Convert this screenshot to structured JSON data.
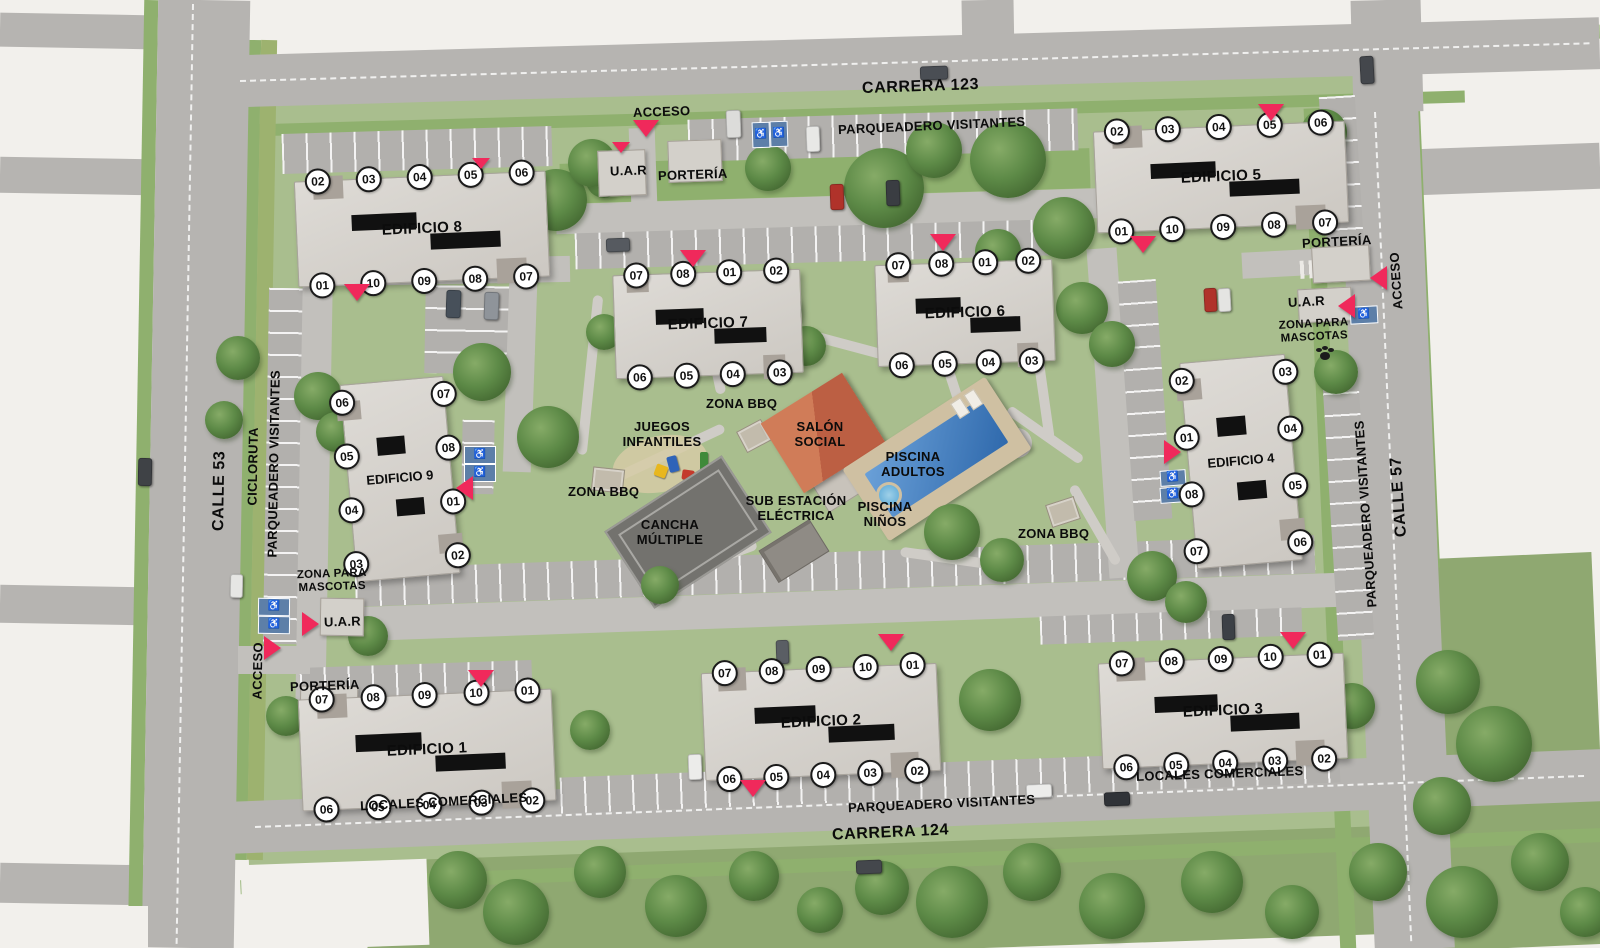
{
  "streets": {
    "carrera_123": "CARRERA 123",
    "carrera_124": "CARRERA 124",
    "calle_53": "CALLE 53",
    "calle_57": "CALLE 57",
    "cicloruta": "CICLORUTA"
  },
  "labels": {
    "parqueadero_visitantes": "PARQUEADERO VISITANTES",
    "acceso": "ACCESO",
    "porteria": "PORTERÍA",
    "uar": "U.A.R",
    "zona_para_mascotas": "ZONA PARA MASCOTAS",
    "zona_bbq": "ZONA BBQ",
    "locales_comerciales": "LOCALES COMERCIALES"
  },
  "amenities": {
    "salon_social": "SALÓN SOCIAL",
    "piscina_adultos": "PISCINA ADULTOS",
    "piscina_ninos": "PISCINA NIÑOS",
    "juegos_infantiles": "JUEGOS INFANTILES",
    "sub_estacion_electrica": "SUB ESTACIÓN ELÉCTRICA",
    "cancha_multiple": "CANCHA MÚLTIPLE"
  },
  "buildings": [
    {
      "id": "edificio-8",
      "name": "EDIFICIO 8",
      "units_top": [
        "02",
        "03",
        "04",
        "05",
        "06"
      ],
      "units_bottom": [
        "01",
        "10",
        "09",
        "08",
        "07"
      ]
    },
    {
      "id": "edificio-5",
      "name": "EDIFICIO 5",
      "units_top": [
        "02",
        "03",
        "04",
        "05",
        "06"
      ],
      "units_bottom": [
        "01",
        "10",
        "09",
        "08",
        "07"
      ]
    },
    {
      "id": "edificio-7",
      "name": "EDIFICIO 7",
      "units_top": [
        "07",
        "08",
        "01",
        "02"
      ],
      "units_bottom": [
        "06",
        "05",
        "04",
        "03"
      ]
    },
    {
      "id": "edificio-6",
      "name": "EDIFICIO 6",
      "units_top": [
        "07",
        "08",
        "01",
        "02"
      ],
      "units_bottom": [
        "06",
        "05",
        "04",
        "03"
      ]
    },
    {
      "id": "edificio-9",
      "name": "EDIFICIO 9",
      "units_left": [
        "06",
        "05",
        "04",
        "03"
      ],
      "units_right": [
        "07",
        "08",
        "01",
        "02"
      ]
    },
    {
      "id": "edificio-4",
      "name": "EDIFICIO 4",
      "units_left": [
        "02",
        "01",
        "08",
        "07"
      ],
      "units_right": [
        "03",
        "04",
        "05",
        "06"
      ]
    },
    {
      "id": "edificio-1",
      "name": "EDIFICIO 1",
      "units_top": [
        "07",
        "08",
        "09",
        "10",
        "01"
      ],
      "units_bottom": [
        "06",
        "05",
        "04",
        "03",
        "02"
      ]
    },
    {
      "id": "edificio-2",
      "name": "EDIFICIO 2",
      "units_top": [
        "07",
        "08",
        "09",
        "10",
        "01"
      ],
      "units_bottom": [
        "06",
        "05",
        "04",
        "03",
        "02"
      ]
    },
    {
      "id": "edificio-3",
      "name": "EDIFICIO 3",
      "units_top": [
        "07",
        "08",
        "09",
        "10",
        "01"
      ],
      "units_bottom": [
        "06",
        "05",
        "04",
        "03",
        "02"
      ]
    }
  ],
  "colors": {
    "marker": "#F0295B",
    "grass": "#A9BE8E",
    "road": "#B6B4B1",
    "building": "#D9D6D1",
    "pool_water": "#3B76B5",
    "salon_roof": "#C4674A",
    "badge_bg": "#FFFFFF",
    "badge_text": "#111111",
    "handicap": "#5D7FA8"
  }
}
